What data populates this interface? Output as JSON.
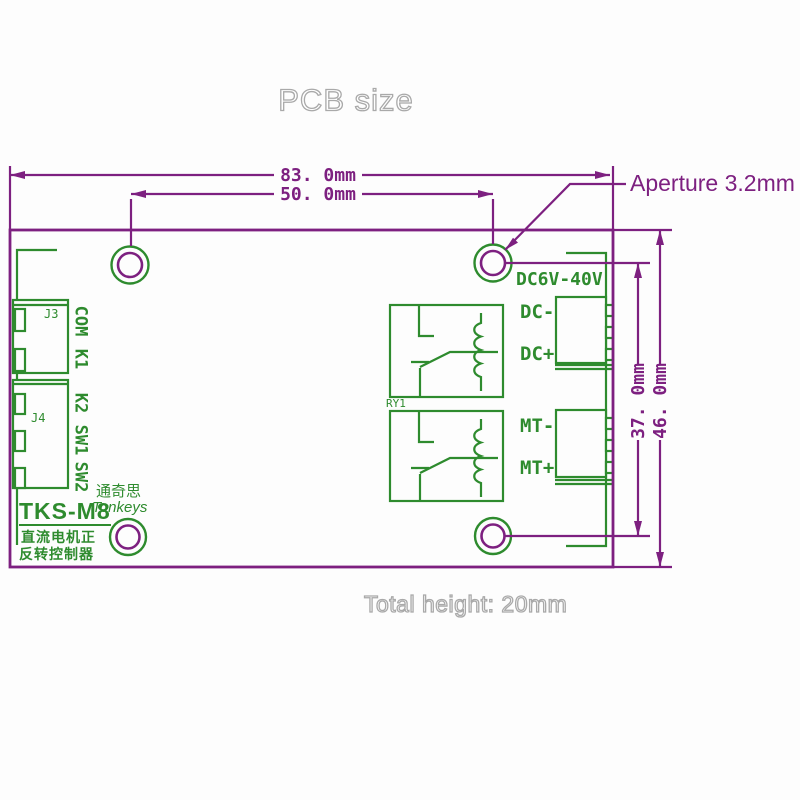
{
  "title": "PCB size",
  "footer_note": "Total height: 20mm",
  "dims": {
    "width_outer": "83. 0mm",
    "width_holes": "50. 0mm",
    "aperture": "Aperture 3.2mm",
    "height_holes": "37. 0mm",
    "height_outer": "46. 0mm"
  },
  "board": {
    "voltage": "DC6V-40V",
    "terminals": [
      "DC-",
      "DC+",
      "MT-",
      "MT+"
    ],
    "connector_labels": [
      "COM",
      "K1",
      "K2",
      "SW1",
      "SW2"
    ],
    "j3_ref": "J3",
    "j4_ref": "J4",
    "relay_ref": "RY1",
    "branding": {
      "cn_name": "通奇思",
      "en_name": "Tonkeys",
      "model": "TKS-M8",
      "desc_line1": "直流电机正",
      "desc_line2": "反转控制器"
    }
  },
  "colors": {
    "line_purple": "#7d2080",
    "line_green": "#2e8b2e",
    "outline_gray": "#a9a9a9"
  }
}
